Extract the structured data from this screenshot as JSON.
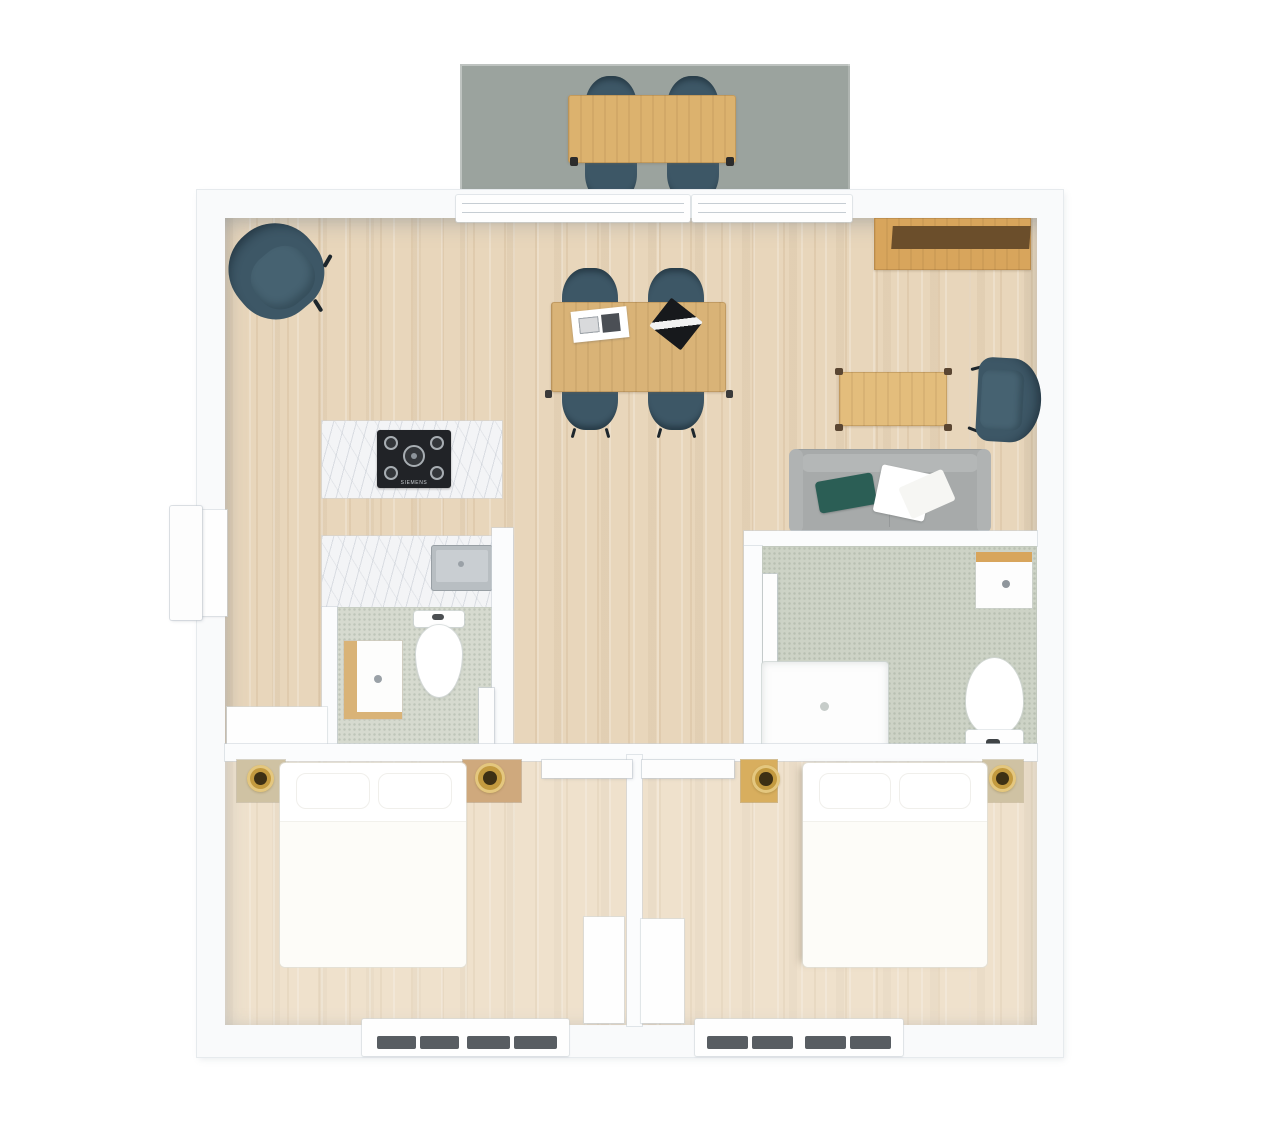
{
  "scene": {
    "type": "floor-plan",
    "view": "top-down 3D render of a two-bedroom apartment with deck"
  },
  "palette": {
    "background": "#ffffff",
    "deck": "#9ba39e",
    "wall": "#fbfcfd",
    "floor_wood": "#e8d6bb",
    "chair_teal": "#3d5766",
    "chair_seat": "#466271",
    "oak_deck_table": "#dcb26e",
    "oak_dining_table": "#d9b377",
    "oak_coffee_table": "#e3bd7c",
    "oak_sideboard": "#d8a55c",
    "oak_dark": "#6b4e2b",
    "sofa_gray": "#a7aaaa",
    "pillow_teal": "#2b5e55",
    "cooktop_black": "#212327",
    "marble": "#f3f4f6",
    "sink_gray": "#b8bec2",
    "bath_floor_left": "#d6dacf",
    "bath_floor_right": "#cdd3c6",
    "gold_lamp": "#c39a3f",
    "window_slat": "#585d62",
    "nightstand_tan": "#cfc2a3",
    "nightstand_wood": "#cfa97d",
    "nightstand_gold": "#d8ae5e"
  },
  "kitchen": {
    "cooktop_brand": "SIEMENS",
    "cooktop_burners": 5
  },
  "rooms": {
    "deck": {
      "furniture": [
        "outdoor dining table",
        "4 outdoor chairs"
      ]
    },
    "living_dining": {
      "furniture": [
        "lounge armchair",
        "dining table",
        "4 dining chairs",
        "laptop",
        "documents",
        "sideboard",
        "coffee table",
        "armchair",
        "sofa",
        "throw pillow",
        "blanket"
      ]
    },
    "kitchen": {
      "furniture": [
        "island counter with gas cooktop",
        "counter with sink"
      ]
    },
    "bathroom_left": {
      "furniture": [
        "toilet",
        "vanity cabinet",
        "sink counter",
        "door"
      ]
    },
    "bathroom_right": {
      "furniture": [
        "shower",
        "toilet",
        "vanity",
        "door"
      ]
    },
    "bedroom_left": {
      "furniture": [
        "double bed",
        "2 nightstands with lamps",
        "dresser",
        "wardrobe",
        "slatted window"
      ]
    },
    "bedroom_right": {
      "furniture": [
        "double bed",
        "2 nightstands with lamps",
        "wardrobe",
        "slatted window"
      ]
    }
  },
  "openings": {
    "entry_door": "left wall",
    "sliding_door": "top wall to deck",
    "bedroom_doors": 2,
    "bathroom_doors": 2,
    "bottom_windows": 2
  }
}
